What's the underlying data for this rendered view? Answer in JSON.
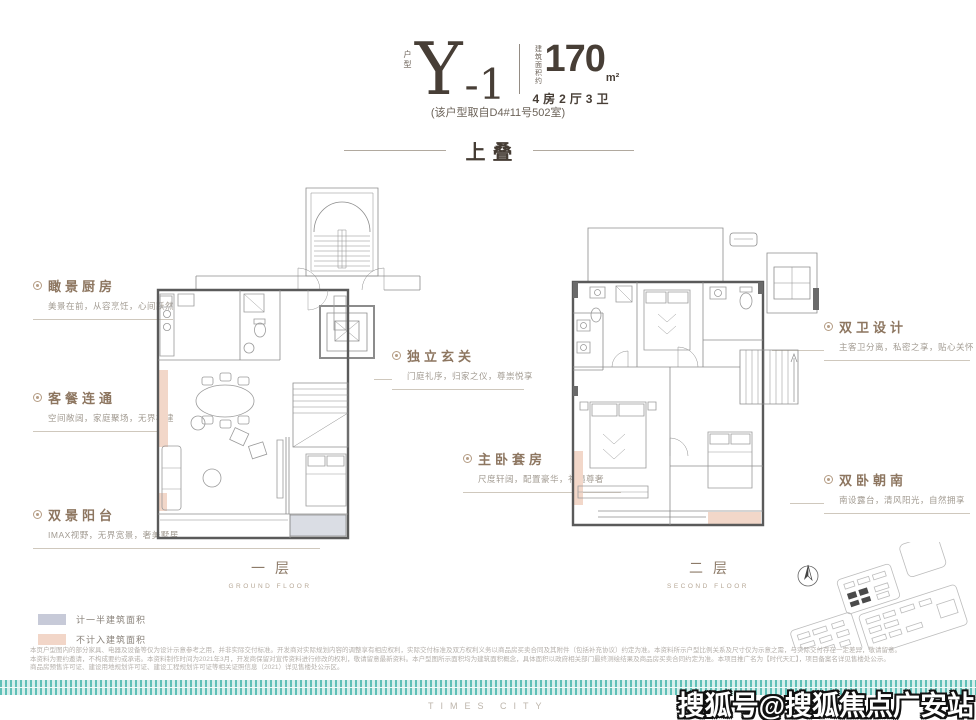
{
  "header": {
    "type_label": "户型",
    "type_main": "Y",
    "type_suffix": "-1",
    "area_label": "建筑面积约",
    "area_value": "170",
    "area_unit": "m²",
    "rooms": "4房2厅3卫",
    "source_note": "(该户型取自D4#11号502室)"
  },
  "section_title": "上叠",
  "annotations": [
    {
      "title": "瞰景厨房",
      "subtitle": "美景在前，从容烹饪，心间跃然"
    },
    {
      "title": "客餐连通",
      "subtitle": "空间敞阔，家庭聚场，无界构建"
    },
    {
      "title": "双景阳台",
      "subtitle": "IMAX视野，无界宽景，奢美墅居"
    },
    {
      "title": "独立玄关",
      "subtitle": "门庭礼序，归家之仪，尊崇悦享"
    },
    {
      "title": "主卧套房",
      "subtitle": "尺度轩阔，配置豪华，礼遇尊奢"
    },
    {
      "title": "双卫设计",
      "subtitle": "主客卫分离，私密之享，贴心关怀"
    },
    {
      "title": "双卧朝南",
      "subtitle": "南设露台，清风阳光，自然拥享"
    }
  ],
  "floors": [
    {
      "label": "一层",
      "sublabel": "GROUND FLOOR"
    },
    {
      "label": "二层",
      "sublabel": "SECOND FLOOR"
    }
  ],
  "legend": [
    {
      "label": "计一半建筑面积",
      "color": "#c7cad8"
    },
    {
      "label": "不计入建筑面积",
      "color": "#f2d6c8"
    }
  ],
  "disclaimer": {
    "line1": "本页户型图内的部分家具、电器及设备等仅为设计示意参考之用，并非实际交付标准。开发商对实际规划内容的调整享有相应权利，实际交付标准及双方权利义务以商品房买卖合同及其附件（包括补充协议）约定为准。本资料所示户型比例关系及尺寸仅为示意之需，与实际交付存在一定差异，敬请留意。",
    "line2": "本资料为要约邀请，不构成要约或承诺。本资料制作时间为2021年3月，开发商保留对宣传资料进行修改的权利，敬请留意最新资料。本户型图所示面积均为建筑面积概念，具体面积以政府相关部门最终测绘结果及商品房买卖合同约定为准。本项目推广名为【时代天汇】，项目备案名详见售楼处公示。",
    "line3": "商品房预售许可证、建设用地规划许可证、建设工程规划许可证等相关证照信息（2021）详见售楼处公示区。"
  },
  "footer": {
    "brand": "TIMES CITY",
    "watermark": "搜狐号@搜狐焦点广安站"
  },
  "colors": {
    "accent_teal": "#5fc0b7",
    "title_dark": "#463d35",
    "annotation_brown": "#8d7660",
    "plan_wall": "#5a5a5a",
    "plan_line": "#8c8c8c",
    "fill_half_area": "#c7cad8",
    "fill_excluded": "#f2d6c8"
  }
}
